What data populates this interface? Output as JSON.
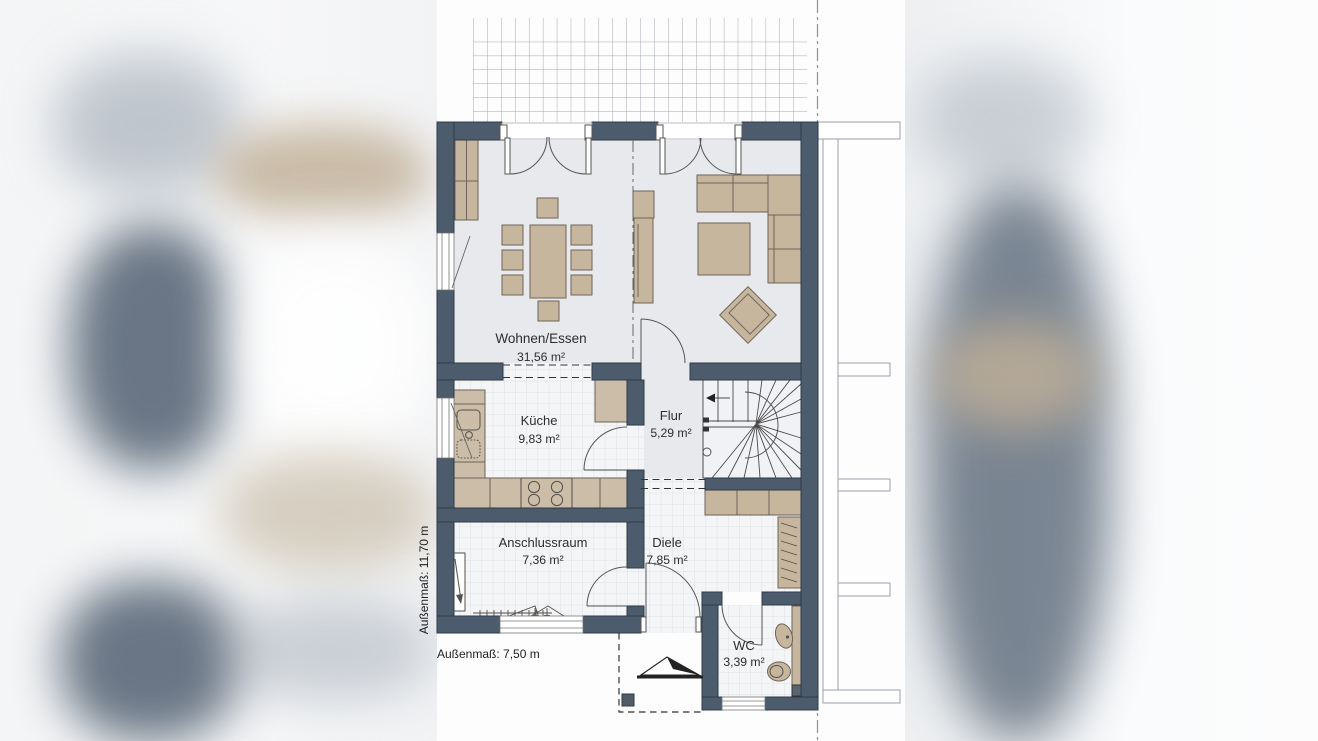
{
  "plan": {
    "title": "Erdgeschoss Grundriss (floor plan)",
    "rooms": [
      {
        "name": "Wohnen/Essen",
        "area": "31,56 m²"
      },
      {
        "name": "Küche",
        "area": "9,83 m²"
      },
      {
        "name": "Flur",
        "area": "5,29 m²"
      },
      {
        "name": "Anschlussraum",
        "area": "7,36 m²"
      },
      {
        "name": "Diele",
        "area": "7,85 m²"
      },
      {
        "name": "WC",
        "area": "3,39 m²"
      }
    ],
    "dimensions": {
      "width_label": "Außenmaß: 7,50 m",
      "height_label": "Außenmaß: 11,70 m"
    },
    "colors": {
      "wall": "#4d5c6d",
      "wall_outline": "#2e3a47",
      "furniture": "#c7b69e",
      "furniture_outline": "#6e6458",
      "floor_gray": "#e8e9ed",
      "floor_tile": "#f4f5f7",
      "tile_line": "#d9dbe0",
      "terrace_grid": "#9aa0a6",
      "background": "#fbfbfc"
    }
  }
}
